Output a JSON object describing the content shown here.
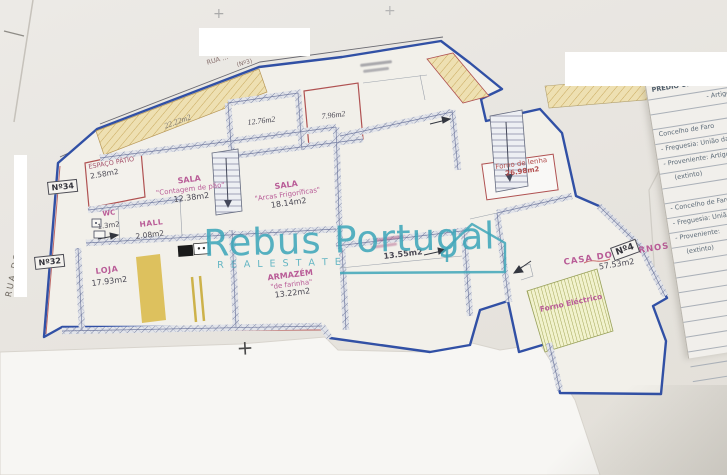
{
  "watermark": {
    "brand": "Rebus Portugal",
    "tagline": "R E A L   E S T A T E",
    "color": "#3fa6b9"
  },
  "streets": {
    "left": "RUA DO …",
    "top": "RUA …",
    "top_number": "(Nº3)"
  },
  "door_numbers": {
    "n34": "Nº34",
    "n32": "Nº32",
    "n4": "Nº4"
  },
  "rooms": {
    "patio": {
      "name": "ESPAÇO PÁTIO",
      "area": "2.58m2"
    },
    "sala_contagem": {
      "name": "SALA",
      "sub": "\"Contagem de pão\"",
      "area": "12.38m2"
    },
    "room_a": {
      "area": "12.76m2"
    },
    "room_b": {
      "area": "7.96m2"
    },
    "sala_arcas": {
      "name": "SALA",
      "sub": "\"Arcas Frigoríficas\"",
      "area": "18.14m2"
    },
    "wc": {
      "name": "WC",
      "area": "1.3m2"
    },
    "hall": {
      "name": "HALL",
      "area": "2.08m2"
    },
    "loja": {
      "name": "LOJA",
      "area": "17.93m2"
    },
    "armazem": {
      "name": "ARMAZÉM",
      "sub": "\"de farinha\"",
      "area": "13.22m2"
    },
    "sala_meio": {
      "area": "13.55m2"
    },
    "terraco": {
      "area": "22.22m2"
    },
    "forno_lenha": {
      "name": "Forno de lenha",
      "area": "26.98m2"
    },
    "casa_fornos": {
      "name": "CASA DOS FORNOS",
      "area": "57.53m2"
    },
    "forno_electrico": {
      "name": "Forno Eléctrico"
    }
  },
  "panel": {
    "rows": [
      "PRÉDIO URBANO - Artigo nº",
      "- Artigo",
      "Concelho de Faro",
      "- Freguesia: União das freg.",
      "- Proveniente: Artigo nº",
      "(extinto)",
      "- Concelho de Faro",
      "- Freguesia: União d",
      "- Proveniente:",
      "(extinto)"
    ]
  },
  "marks": {
    "plus": "+"
  },
  "colors": {
    "boundary_blue": "#3150a5",
    "accent_red": "#b34f4f",
    "label_pink": "#b95c97",
    "hatch_yellow": "#dfc06a",
    "watermark_teal": "#3fa6b9"
  }
}
